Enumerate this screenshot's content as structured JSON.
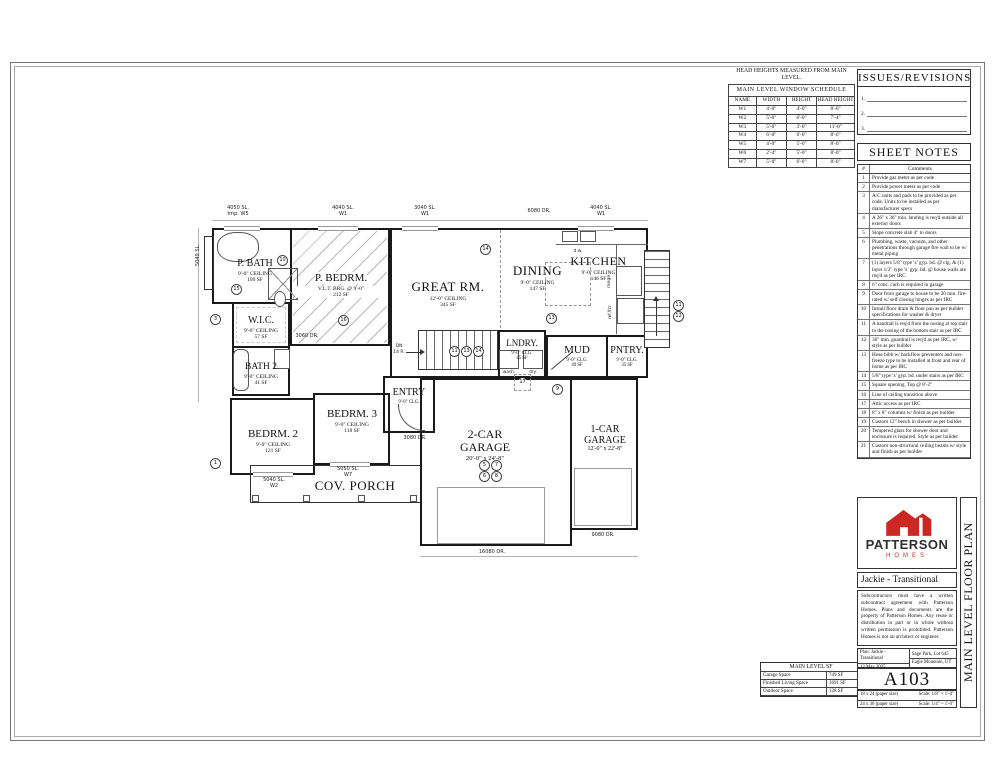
{
  "colors": {
    "brand_red": "#cc2823",
    "brand_dark": "#2e2e36",
    "line": "#1a1a1a"
  },
  "window_schedule": {
    "caption": "HEAD HEIGHTS MEASURED FROM MAIN LEVEL.",
    "title": "MAIN LEVEL WINDOW SCHEDULE",
    "columns": [
      "NAME",
      "WIDTH",
      "HEIGHT",
      "HEAD HEIGHT"
    ],
    "rows": [
      [
        "W1",
        "4'-0\"",
        "4'-0\"",
        "8'-0\""
      ],
      [
        "W2",
        "5'-0\"",
        "6'-0\"",
        "7'-4\""
      ],
      [
        "W3",
        "5'-0\"",
        "3'-0\"",
        "11'-0\""
      ],
      [
        "W4",
        "6'-0\"",
        "6'-0\"",
        "8'-0\""
      ],
      [
        "W5",
        "4'-0\"",
        "5'-0\"",
        "8'-0\""
      ],
      [
        "W6",
        "2'-4\"",
        "5'-0\"",
        "8'-0\""
      ],
      [
        "W7",
        "5'-0\"",
        "6'-0\"",
        "8'-0\""
      ]
    ]
  },
  "issues": {
    "title": "ISSUES/REVISIONS",
    "lines": [
      "1.",
      "2.",
      "3."
    ]
  },
  "sheet_notes": {
    "title": "SHEET NOTES",
    "col_num": "#",
    "col_comments": "Comments",
    "notes": [
      {
        "n": "1",
        "t": "Provide gas meter as per code"
      },
      {
        "n": "2",
        "t": "Provide power meter as per code"
      },
      {
        "n": "3",
        "t": "A/C units and pads to be provided as per code. Units to be installed as per manufacturer specs"
      },
      {
        "n": "4",
        "t": "A 36\" x 36\" min. landing is req'd outside all exterior doors"
      },
      {
        "n": "5",
        "t": "Slope concrete slab 4\" to doors"
      },
      {
        "n": "6",
        "t": "Plumbing, waste, vacuum, and other penetrations through garage fire wall to be w/ metal piping"
      },
      {
        "n": "7",
        "t": "(1) layers 5/8\" type 'x' gyp. bd. @ clg. & (1) layer 1/2\" type 'x' gyp. bd. @ house walls are req'd as per IRC"
      },
      {
        "n": "8",
        "t": "6\" conc. curb is required in garage"
      },
      {
        "n": "9",
        "t": "Door from garage to house to be 20 min. fire-rated w/ self closing hinges as per IRC"
      },
      {
        "n": "10",
        "t": "Install floor drain & floor pan as per builder specifications for washer & dryer"
      },
      {
        "n": "11",
        "t": "A handrail is req'd from the nosing at top stair to the nosing of the bottom stair as per IRC"
      },
      {
        "n": "12",
        "t": "36\" min. guardrail is req'd as per IRC, w/ style as per builder"
      },
      {
        "n": "13",
        "t": "Hose bibb w/ backflow preventers and non-freeze type to be installed at front and rear of home as per IRC"
      },
      {
        "n": "14",
        "t": "5/8\" type 'x' gyp. bd. under stairs as per IRC"
      },
      {
        "n": "15",
        "t": "Square opening. Top @ 8'-2\""
      },
      {
        "n": "16",
        "t": "Line of ceiling transition above"
      },
      {
        "n": "17",
        "t": "Attic access as per IRC"
      },
      {
        "n": "18",
        "t": "8\" x 8\" columns w/ finish as per builder"
      },
      {
        "n": "19",
        "t": "Custom 12\" bench in shower as per builder"
      },
      {
        "n": "20",
        "t": "Tempered glass for shower door and enclosure is required. Style as per builder"
      },
      {
        "n": "21",
        "t": "Custom non-structural ceiling beams w/ style and finish as per builder"
      }
    ]
  },
  "sf_table": {
    "title": "MAIN LEVEL SF",
    "rows": [
      {
        "label": "Garage Space",
        "value": "749 SF"
      },
      {
        "label": "Finished Living Space",
        "value": "1691 SF"
      },
      {
        "label": "Outdoor Space",
        "value": "128 SF"
      }
    ]
  },
  "title_block": {
    "brand": "PATTERSON",
    "brand_sub": "HOMES",
    "plan_title": "Jackie - Transitional",
    "disclaimer": "Subcontractors must have a written subcontract agreement with Patterson Homes. Plans and documents are the property of Patterson Homes. Any reuse or distribution in part or in whole without written permission is prohibited. Patterson Homes is not an architect or engineer.",
    "plan_label": "Plan: Jackie - Transitional",
    "location": "Sage Park, Lot 645",
    "date": "12 May 2025",
    "city": "Eagle Mountain, UT",
    "sheet_number": "A103",
    "paper1": "18 x 24 (paper size)",
    "scale1": "Scale: 1/8\" = 1'-0\"",
    "paper2": "24 x 36 (paper size)",
    "scale2": "Scale: 1/4\" = 1'-0\"",
    "sheet_title": "MAIN LEVEL FLOOR PLAN"
  },
  "plan": {
    "rooms": [
      {
        "name": "P. BATH",
        "ceil": "9'-0\" CEILING",
        "sf": "109 SF"
      },
      {
        "name": "P. BEDRM.",
        "ceil": "V.L.T. BRG. @ 9'-0\"",
        "sf": "212 SF"
      },
      {
        "name": "W.I.C.",
        "ceil": "9'-0\" CEILING",
        "sf": "57 SF"
      },
      {
        "name": "BATH 2",
        "ceil": "9'-0\" CEILING",
        "sf": "41 SF"
      },
      {
        "name": "GREAT RM.",
        "ceil": "12'-0\" CEILING",
        "sf": "345 SF"
      },
      {
        "name": "DINING",
        "ceil": "9'-0\" CEILING",
        "sf": "147 SF"
      },
      {
        "name": "KITCHEN",
        "ceil": "9'-0\" CEILING",
        "sf": "146 SF"
      },
      {
        "name": "LNDRY.",
        "ceil": "9'-0\" CLG.",
        "sf": "45 SF"
      },
      {
        "name": "MUD",
        "ceil": "9'-0\" CLG.",
        "sf": "49 SF"
      },
      {
        "name": "PNTRY.",
        "ceil": "9'-0\" CLG.",
        "sf": "35 SF"
      },
      {
        "name": "ENTRY",
        "ceil": "9'-0\" CLG.",
        "sf": ""
      },
      {
        "name": "BEDRM. 2",
        "ceil": "9'-0\" CEILING",
        "sf": "121 SF"
      },
      {
        "name": "BEDRM. 3",
        "ceil": "9'-0\" CEILING",
        "sf": "118 SF"
      },
      {
        "name": "2-CAR",
        "name2": "GARAGE",
        "dim": "20'-0\" x 24'-8\""
      },
      {
        "name": "1-CAR",
        "name2": "GARAGE",
        "dim": "12'-0\" x 22'-8\""
      },
      {
        "name": "COV. PORCH"
      }
    ],
    "fixtures": {
      "dw": "d.w.",
      "range": "range",
      "ref": "ref./fzr.",
      "wash": "wash.",
      "dry": "dry."
    },
    "stairs": {
      "dn": "DN",
      "dn_count": "14 R."
    },
    "tags": [
      {
        "l1": "4050 SL.",
        "l2": "tmp. W5"
      },
      {
        "l1": "4040 SL.",
        "l2": "W1"
      },
      {
        "l1": "3040 SL.",
        "l2": "W1"
      },
      {
        "l1": "6080 DR.",
        "l2": ""
      },
      {
        "l1": "4040 SL.",
        "l2": "W1"
      },
      {
        "l1": "5040 SL.",
        "l2": "W4"
      },
      {
        "l1": "5050 SL.",
        "l2": "W7"
      },
      {
        "l1": "5040 SL.",
        "l2": "W2"
      },
      {
        "l1": "3080 DR.",
        "l2": ""
      },
      {
        "l1": "3060 DR.",
        "l2": ""
      },
      {
        "l1": "16080 DR.",
        "l2": ""
      },
      {
        "l1": "9080 DR.",
        "l2": ""
      }
    ],
    "note_refs": [
      "10",
      "15",
      "16",
      "3",
      "1",
      "14",
      "13",
      "17",
      "9",
      "11",
      "13",
      "14",
      "11",
      "12",
      "5",
      "7",
      "6",
      "8"
    ]
  }
}
